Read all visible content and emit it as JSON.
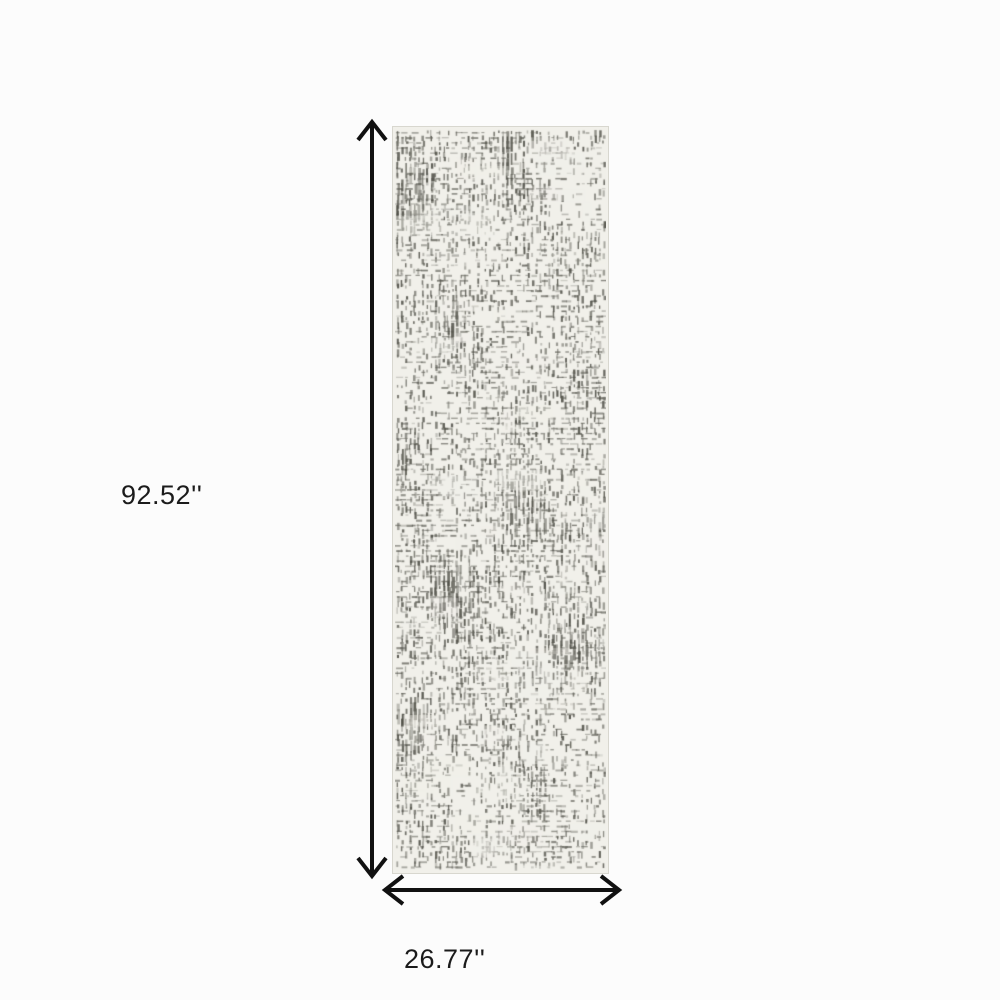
{
  "page": {
    "background_color": "#fcfcfc"
  },
  "dimensions": {
    "height_label": "92.52''",
    "width_label": "26.77''"
  },
  "rug": {
    "base_color": "#f1f0ea",
    "pattern_dark_color": "#4e4e46",
    "pattern_mid_color": "#62625a",
    "edge_color": "#d8d7cf",
    "pattern_style": "distressed-crosshatch-grid"
  },
  "arrows": {
    "color": "#111111",
    "height_arrow": "vertical-double-headed",
    "width_arrow": "horizontal-double-headed"
  },
  "text_color": "#1b1b1b"
}
